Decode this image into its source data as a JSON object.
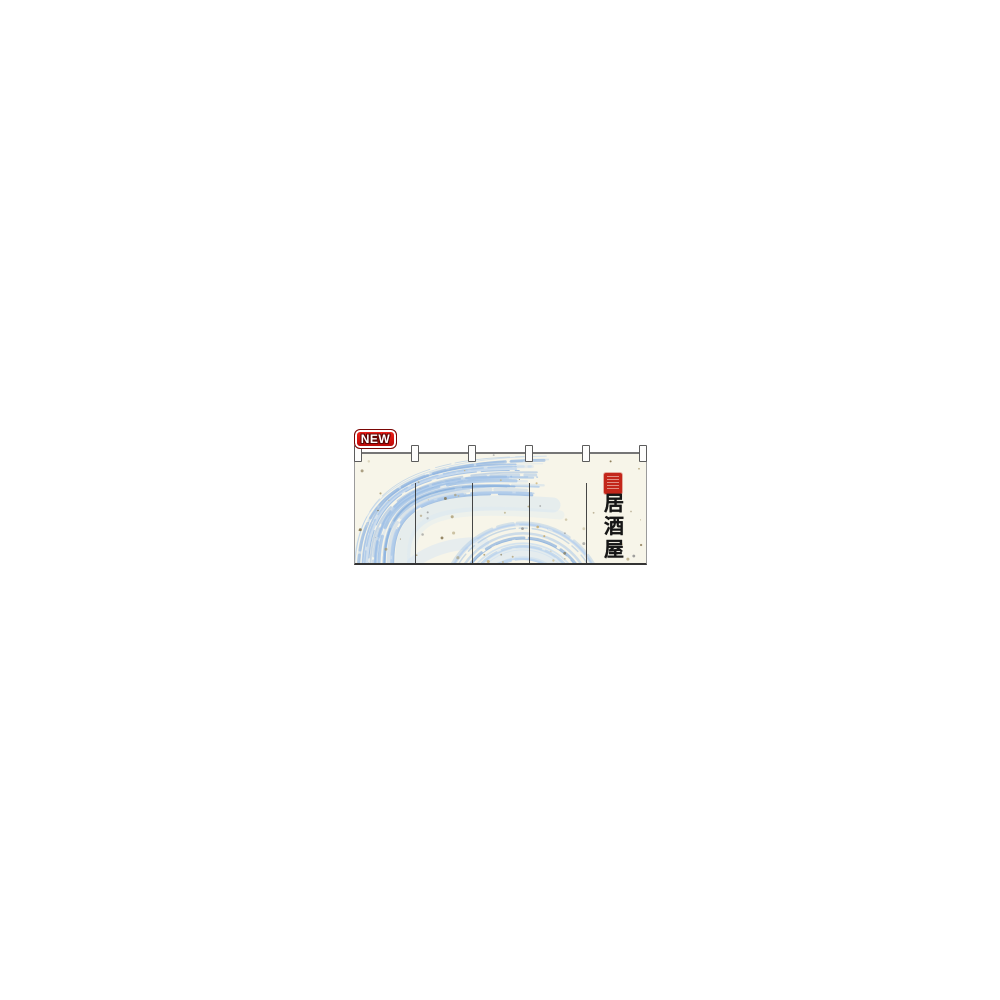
{
  "image": {
    "description": "Product photo of a Japanese noren shop curtain on a plain white background"
  },
  "badge": {
    "label": "NEW"
  },
  "noren": {
    "title_vertical": "居酒屋",
    "panel_count": 5,
    "tab_count": 6,
    "colors": {
      "fabric": "#f7f5e9",
      "brush_blue": "#a6c6e9",
      "title_text": "#161616",
      "seal_red": "#c3261a",
      "badge_red": "#d5120e"
    }
  }
}
